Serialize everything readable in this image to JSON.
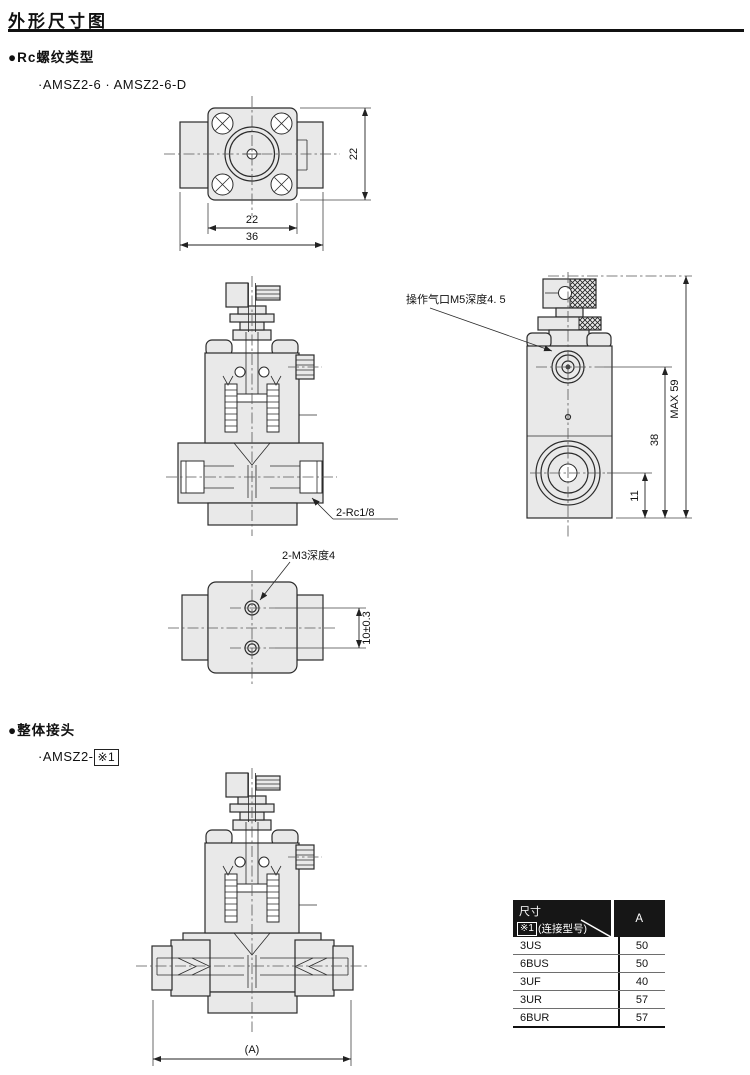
{
  "page": {
    "title": "外形尺寸图"
  },
  "rc_section": {
    "heading": "●Rc螺纹类型",
    "models": "·AMSZ2-6 · AMSZ2-6-D"
  },
  "fitting_section": {
    "heading": "●整体接头",
    "model_prefix": "·AMSZ2-",
    "model_ref": "※1"
  },
  "drawings": {
    "top_view": {
      "dim_side": "22",
      "dim_square": "22",
      "dim_overall": "36"
    },
    "front_section": {
      "port_label": "2-Rc1/8"
    },
    "side_view": {
      "pilot_port_label": "操作气口M5深度4. 5",
      "dim_max_height": "MAX 59",
      "dim_port_height": "38",
      "dim_outlet_height": "11"
    },
    "bottom_view": {
      "thread_label": "2-M3深度4",
      "dim_hole_pitch": "10±0.3"
    },
    "fitting_front_section": {
      "dim_width": "(A)"
    }
  },
  "table": {
    "header_dim": "尺寸",
    "header_ref": "※1",
    "header_ref_note": "(连接型号)",
    "header_col_a": "A",
    "rows": [
      {
        "model": "3US",
        "a": "50"
      },
      {
        "model": "6BUS",
        "a": "50"
      },
      {
        "model": "3UF",
        "a": "40"
      },
      {
        "model": "3UR",
        "a": "57"
      },
      {
        "model": "6BUR",
        "a": "57"
      }
    ]
  }
}
